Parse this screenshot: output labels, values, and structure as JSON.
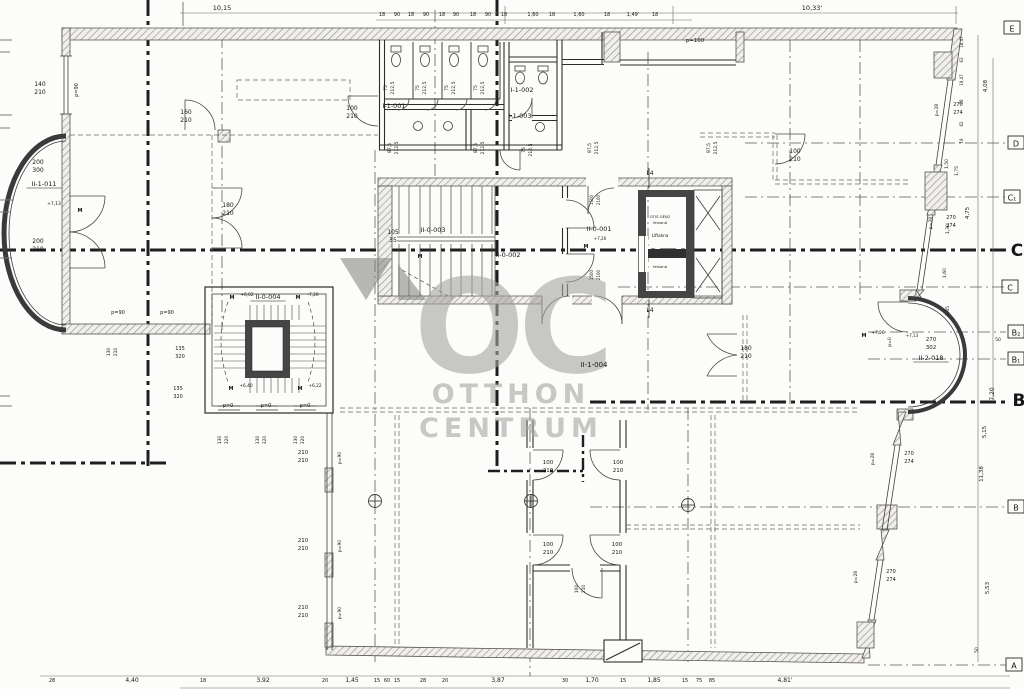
{
  "watermark": {
    "logo": "OC",
    "line1": "OTTHON",
    "line2": "CENTRUM",
    "color": "#a5a4a2"
  },
  "colors": {
    "ink": "#161616",
    "wall_dark": "#454545",
    "hatch_line": "#8f8d89",
    "axis": "#1f1f1f",
    "background": "#fcfcfa"
  },
  "grid_letters": [
    {
      "t": "E",
      "x": 1012,
      "y": 28
    },
    {
      "t": "D",
      "x": 1016,
      "y": 143
    },
    {
      "t": "C₁",
      "x": 1012,
      "y": 197
    },
    {
      "t": "C",
      "x": 1017,
      "y": 250,
      "big": 1
    },
    {
      "t": "C",
      "x": 1010,
      "y": 287
    },
    {
      "t": "B₂",
      "x": 1016,
      "y": 332
    },
    {
      "t": "B₁",
      "x": 1016,
      "y": 359
    },
    {
      "t": "B",
      "x": 1019,
      "y": 400,
      "big": 1
    },
    {
      "t": "B",
      "x": 1016,
      "y": 507
    },
    {
      "t": "A",
      "x": 1014,
      "y": 665
    }
  ],
  "annotations": [
    {
      "k": "room",
      "t": "II-1-011",
      "x": 44,
      "y": 186,
      "s": 6.5,
      "u": 1
    },
    {
      "k": "room",
      "t": "I-1-001",
      "x": 394,
      "y": 108,
      "s": 6.5
    },
    {
      "k": "room",
      "t": "I-1-002",
      "x": 522,
      "y": 92,
      "s": 6.5
    },
    {
      "k": "room",
      "t": "I-1-003",
      "x": 520,
      "y": 118,
      "s": 6.5
    },
    {
      "k": "room",
      "t": "II-0-003",
      "x": 433,
      "y": 232,
      "s": 6.5
    },
    {
      "k": "room",
      "t": "II-0-001",
      "x": 599,
      "y": 231,
      "s": 6.5
    },
    {
      "k": "room",
      "t": "II-0-002",
      "x": 508,
      "y": 257,
      "s": 6.5
    },
    {
      "k": "room",
      "t": "II-0-004",
      "x": 268,
      "y": 299,
      "s": 6.5,
      "u": 1
    },
    {
      "k": "room",
      "t": "II-1-004",
      "x": 594,
      "y": 367,
      "s": 7
    },
    {
      "k": "room",
      "t": "II-2-018",
      "x": 931,
      "y": 360,
      "s": 6.5,
      "u": 1
    },
    {
      "k": "dim",
      "t": "10,15",
      "x": 222,
      "y": 10,
      "s": 6.5
    },
    {
      "k": "dim",
      "t": "10,33'",
      "x": 812,
      "y": 10,
      "s": 6.5
    },
    {
      "k": "dim",
      "t": "18",
      "x": 382,
      "y": 16,
      "s": 5
    },
    {
      "k": "dim",
      "t": "90",
      "x": 397,
      "y": 16,
      "s": 5
    },
    {
      "k": "dim",
      "t": "18",
      "x": 411,
      "y": 16,
      "s": 5
    },
    {
      "k": "dim",
      "t": "90",
      "x": 426,
      "y": 16,
      "s": 5
    },
    {
      "k": "dim",
      "t": "18",
      "x": 442,
      "y": 16,
      "s": 5
    },
    {
      "k": "dim",
      "t": "90",
      "x": 456,
      "y": 16,
      "s": 5
    },
    {
      "k": "dim",
      "t": "18",
      "x": 473,
      "y": 16,
      "s": 5
    },
    {
      "k": "dim",
      "t": "90",
      "x": 488,
      "y": 16,
      "s": 5
    },
    {
      "k": "dim",
      "t": "18",
      "x": 504,
      "y": 16,
      "s": 5
    },
    {
      "k": "dim",
      "t": "1,60",
      "x": 533,
      "y": 16,
      "s": 5
    },
    {
      "k": "dim",
      "t": "18",
      "x": 552,
      "y": 16,
      "s": 5
    },
    {
      "k": "dim",
      "t": "1,60",
      "x": 579,
      "y": 16,
      "s": 5
    },
    {
      "k": "dim",
      "t": "18",
      "x": 607,
      "y": 16,
      "s": 5
    },
    {
      "k": "dim",
      "t": "1,49'",
      "x": 633,
      "y": 16,
      "s": 5
    },
    {
      "k": "dim",
      "t": "18",
      "x": 655,
      "y": 16,
      "s": 5
    },
    {
      "k": "dim",
      "t": "p=100",
      "x": 695,
      "y": 42,
      "s": 5.5
    },
    {
      "k": "dim",
      "t": "75",
      "x": 387,
      "y": 88,
      "r": 1,
      "s": 4.5
    },
    {
      "k": "dim",
      "t": "212,5",
      "x": 394,
      "y": 88,
      "r": 1,
      "s": 4.5
    },
    {
      "k": "dim",
      "t": "75",
      "x": 419,
      "y": 88,
      "r": 1,
      "s": 4.5
    },
    {
      "k": "dim",
      "t": "212,5",
      "x": 426,
      "y": 88,
      "r": 1,
      "s": 4.5
    },
    {
      "k": "dim",
      "t": "75",
      "x": 448,
      "y": 88,
      "r": 1,
      "s": 4.5
    },
    {
      "k": "dim",
      "t": "212,5",
      "x": 455,
      "y": 88,
      "r": 1,
      "s": 4.5
    },
    {
      "k": "dim",
      "t": "75",
      "x": 477,
      "y": 88,
      "r": 1,
      "s": 4.5
    },
    {
      "k": "dim",
      "t": "212,5",
      "x": 484,
      "y": 88,
      "r": 1,
      "s": 4.5
    },
    {
      "k": "dim",
      "t": "87,5",
      "x": 391,
      "y": 148,
      "r": 1,
      "s": 4.5
    },
    {
      "k": "dim",
      "t": "212,5",
      "x": 398,
      "y": 148,
      "r": 1,
      "s": 4.5
    },
    {
      "k": "dim",
      "t": "87,5",
      "x": 477,
      "y": 148,
      "r": 1,
      "s": 4.5
    },
    {
      "k": "dim",
      "t": "212,5",
      "x": 484,
      "y": 148,
      "r": 1,
      "s": 4.5
    },
    {
      "k": "dim",
      "t": "75",
      "x": 525,
      "y": 150,
      "r": 1,
      "s": 4.5
    },
    {
      "k": "dim",
      "t": "212,5",
      "x": 532,
      "y": 150,
      "r": 1,
      "s": 4.5
    },
    {
      "k": "dim",
      "t": "87,5",
      "x": 591,
      "y": 148,
      "r": 1,
      "s": 4.5
    },
    {
      "k": "dim",
      "t": "212,5",
      "x": 598,
      "y": 148,
      "r": 1,
      "s": 4.5
    },
    {
      "k": "dim",
      "t": "87,5",
      "x": 710,
      "y": 148,
      "r": 1,
      "s": 4.5
    },
    {
      "k": "dim",
      "t": "212,5",
      "x": 717,
      "y": 148,
      "r": 1,
      "s": 4.5
    },
    {
      "k": "dim",
      "t": "140",
      "x": 40,
      "y": 86,
      "s": 6
    },
    {
      "k": "dim",
      "t": "210",
      "x": 40,
      "y": 94,
      "s": 6
    },
    {
      "k": "dim",
      "t": "p=90",
      "x": 78,
      "y": 90,
      "r": 1,
      "s": 5
    },
    {
      "k": "dim",
      "t": "160",
      "x": 186,
      "y": 114,
      "s": 6
    },
    {
      "k": "dim",
      "t": "210",
      "x": 186,
      "y": 122,
      "s": 6
    },
    {
      "k": "dim",
      "t": "100",
      "x": 352,
      "y": 110,
      "s": 6
    },
    {
      "k": "dim",
      "t": "210",
      "x": 352,
      "y": 118,
      "s": 6
    },
    {
      "k": "dim",
      "t": "180",
      "x": 228,
      "y": 207,
      "s": 6
    },
    {
      "k": "dim",
      "t": "210",
      "x": 228,
      "y": 215,
      "s": 6
    },
    {
      "k": "dim",
      "t": "200",
      "x": 38,
      "y": 164,
      "s": 6
    },
    {
      "k": "dim",
      "t": "300",
      "x": 38,
      "y": 172,
      "s": 6
    },
    {
      "k": "level",
      "t": "+7,13",
      "x": 54,
      "y": 205,
      "s": 4.5
    },
    {
      "k": "mark",
      "t": "M",
      "x": 80,
      "y": 212,
      "s": 5,
      "b": 1
    },
    {
      "k": "dim",
      "t": "200",
      "x": 38,
      "y": 243,
      "s": 6
    },
    {
      "k": "dim",
      "t": "210",
      "x": 38,
      "y": 251,
      "s": 6
    },
    {
      "k": "dim",
      "t": "p=90",
      "x": 118,
      "y": 314,
      "s": 5
    },
    {
      "k": "dim",
      "t": "p=90",
      "x": 167,
      "y": 314,
      "s": 5
    },
    {
      "k": "dim",
      "t": "130",
      "x": 110,
      "y": 352,
      "r": 1,
      "s": 4.5
    },
    {
      "k": "dim",
      "t": "210",
      "x": 117,
      "y": 352,
      "r": 1,
      "s": 4.5
    },
    {
      "k": "dim",
      "t": "135",
      "x": 180,
      "y": 350,
      "s": 5
    },
    {
      "k": "dim",
      "t": "320",
      "x": 180,
      "y": 358,
      "s": 5
    },
    {
      "k": "dim",
      "t": "135",
      "x": 178,
      "y": 390,
      "s": 5
    },
    {
      "k": "dim",
      "t": "320",
      "x": 178,
      "y": 398,
      "s": 5
    },
    {
      "k": "dim",
      "t": "105",
      "x": 393,
      "y": 234,
      "s": 6
    },
    {
      "k": "dim",
      "t": "35",
      "x": 393,
      "y": 242,
      "s": 6
    },
    {
      "k": "mark",
      "t": "L4",
      "x": 650,
      "y": 175,
      "s": 6
    },
    {
      "k": "mark",
      "t": "L4",
      "x": 650,
      "y": 312,
      "s": 6
    },
    {
      "k": "dim",
      "t": "1500",
      "x": 593,
      "y": 200,
      "r": 1,
      "s": 4
    },
    {
      "k": "dim",
      "t": "2100",
      "x": 600,
      "y": 200,
      "r": 1,
      "s": 4
    },
    {
      "k": "dim",
      "t": "1500",
      "x": 593,
      "y": 275,
      "r": 1,
      "s": 4
    },
    {
      "k": "dim",
      "t": "2100",
      "x": 600,
      "y": 275,
      "r": 1,
      "s": 4
    },
    {
      "k": "mark",
      "t": "M",
      "x": 586,
      "y": 248,
      "s": 5,
      "b": 1
    },
    {
      "k": "level",
      "t": "+7,26",
      "x": 600,
      "y": 240,
      "s": 4
    },
    {
      "k": "mark",
      "t": "M",
      "x": 420,
      "y": 258,
      "s": 5,
      "b": 1
    },
    {
      "k": "label",
      "t": "OTIS GEN2",
      "x": 660,
      "y": 218,
      "s": 3.8
    },
    {
      "k": "label",
      "t": "felvonó",
      "x": 660,
      "y": 224,
      "s": 3.8
    },
    {
      "k": "label",
      "t": "Liftakna",
      "x": 660,
      "y": 237,
      "s": 4.2
    },
    {
      "k": "label",
      "t": "felvonó",
      "x": 660,
      "y": 268,
      "s": 3.8
    },
    {
      "k": "mark",
      "t": "M",
      "x": 232,
      "y": 299,
      "s": 5,
      "b": 1
    },
    {
      "k": "level",
      "t": "+6,02",
      "x": 247,
      "y": 296,
      "s": 4.3
    },
    {
      "k": "mark",
      "t": "M",
      "x": 298,
      "y": 299,
      "s": 5,
      "b": 1
    },
    {
      "k": "level",
      "t": "-7,20",
      "x": 313,
      "y": 296,
      "s": 4.3
    },
    {
      "k": "mark",
      "t": "M",
      "x": 231,
      "y": 390,
      "s": 5,
      "b": 1
    },
    {
      "k": "level",
      "t": "+6,40",
      "x": 246,
      "y": 387,
      "s": 4.3
    },
    {
      "k": "mark",
      "t": "M",
      "x": 300,
      "y": 390,
      "s": 5,
      "b": 1
    },
    {
      "k": "level",
      "t": "+6,22",
      "x": 315,
      "y": 387,
      "s": 4.3
    },
    {
      "k": "dim",
      "t": "p=0",
      "x": 228,
      "y": 407,
      "s": 5
    },
    {
      "k": "dim",
      "t": "p=0",
      "x": 266,
      "y": 407,
      "s": 5
    },
    {
      "k": "dim",
      "t": "p=0",
      "x": 305,
      "y": 407,
      "s": 5
    },
    {
      "k": "dim",
      "t": "130",
      "x": 221,
      "y": 440,
      "r": 1,
      "s": 4.5
    },
    {
      "k": "dim",
      "t": "320",
      "x": 228,
      "y": 440,
      "r": 1,
      "s": 4.5
    },
    {
      "k": "dim",
      "t": "130",
      "x": 259,
      "y": 440,
      "r": 1,
      "s": 4.5
    },
    {
      "k": "dim",
      "t": "320",
      "x": 266,
      "y": 440,
      "r": 1,
      "s": 4.5
    },
    {
      "k": "dim",
      "t": "130",
      "x": 297,
      "y": 440,
      "r": 1,
      "s": 4.5
    },
    {
      "k": "dim",
      "t": "320",
      "x": 304,
      "y": 440,
      "r": 1,
      "s": 4.5
    },
    {
      "k": "dim",
      "t": "210",
      "x": 303,
      "y": 454,
      "s": 5.5
    },
    {
      "k": "dim",
      "t": "210",
      "x": 303,
      "y": 462,
      "s": 5.5
    },
    {
      "k": "dim",
      "t": "p=90",
      "x": 341,
      "y": 458,
      "r": 1,
      "s": 4.5
    },
    {
      "k": "dim",
      "t": "210",
      "x": 303,
      "y": 542,
      "s": 5.5
    },
    {
      "k": "dim",
      "t": "210",
      "x": 303,
      "y": 550,
      "s": 5.5
    },
    {
      "k": "dim",
      "t": "p=90",
      "x": 341,
      "y": 546,
      "r": 1,
      "s": 4.5
    },
    {
      "k": "dim",
      "t": "210",
      "x": 303,
      "y": 609,
      "s": 5.5
    },
    {
      "k": "dim",
      "t": "210",
      "x": 303,
      "y": 617,
      "s": 5.5
    },
    {
      "k": "dim",
      "t": "p=90",
      "x": 341,
      "y": 613,
      "r": 1,
      "s": 4.5
    },
    {
      "k": "dim",
      "t": "100",
      "x": 795,
      "y": 153,
      "s": 6
    },
    {
      "k": "dim",
      "t": "210",
      "x": 795,
      "y": 161,
      "s": 6
    },
    {
      "k": "dim",
      "t": "180",
      "x": 746,
      "y": 350,
      "s": 6
    },
    {
      "k": "dim",
      "t": "210",
      "x": 746,
      "y": 358,
      "s": 6
    },
    {
      "k": "dim",
      "t": "270",
      "x": 931,
      "y": 341,
      "s": 5.5
    },
    {
      "k": "dim",
      "t": "302",
      "x": 931,
      "y": 349,
      "s": 5.5
    },
    {
      "k": "mark",
      "t": "M",
      "x": 864,
      "y": 337,
      "s": 5,
      "b": 1
    },
    {
      "k": "level",
      "t": "+7,26",
      "x": 878,
      "y": 334,
      "s": 4.3
    },
    {
      "k": "level",
      "t": "+7,13",
      "x": 912,
      "y": 337,
      "s": 4
    },
    {
      "k": "dim",
      "t": "p=0",
      "x": 891,
      "y": 342,
      "r": 1,
      "s": 4.5
    },
    {
      "k": "dim",
      "t": "p=28",
      "x": 938,
      "y": 110,
      "r": 1,
      "s": 4.5
    },
    {
      "k": "dim",
      "t": "270",
      "x": 958,
      "y": 106,
      "s": 5
    },
    {
      "k": "dim",
      "t": "274",
      "x": 958,
      "y": 114,
      "s": 5
    },
    {
      "k": "dim",
      "t": "p=28",
      "x": 932,
      "y": 223,
      "r": 1,
      "s": 4.5
    },
    {
      "k": "dim",
      "t": "270",
      "x": 951,
      "y": 219,
      "s": 5
    },
    {
      "k": "dim",
      "t": "274",
      "x": 951,
      "y": 227,
      "s": 5
    },
    {
      "k": "dim",
      "t": "p=28",
      "x": 874,
      "y": 459,
      "r": 1,
      "s": 4.5
    },
    {
      "k": "dim",
      "t": "270",
      "x": 909,
      "y": 455,
      "s": 5
    },
    {
      "k": "dim",
      "t": "274",
      "x": 909,
      "y": 463,
      "s": 5
    },
    {
      "k": "dim",
      "t": "p=28",
      "x": 857,
      "y": 577,
      "r": 1,
      "s": 4.5
    },
    {
      "k": "dim",
      "t": "270",
      "x": 891,
      "y": 573,
      "s": 5
    },
    {
      "k": "dim",
      "t": "274",
      "x": 891,
      "y": 581,
      "s": 5
    },
    {
      "k": "dim",
      "t": "18,47",
      "x": 963,
      "y": 42,
      "r": 1,
      "s": 4
    },
    {
      "k": "dim",
      "t": "63",
      "x": 963,
      "y": 60,
      "r": 1,
      "s": 4
    },
    {
      "k": "dim",
      "t": "19,47",
      "x": 963,
      "y": 80,
      "r": 1,
      "s": 4
    },
    {
      "k": "dim",
      "t": "78",
      "x": 963,
      "y": 102,
      "r": 1,
      "s": 4
    },
    {
      "k": "dim",
      "t": "62",
      "x": 963,
      "y": 124,
      "r": 1,
      "s": 4
    },
    {
      "k": "dim",
      "t": "19",
      "x": 963,
      "y": 141,
      "r": 1,
      "s": 4
    },
    {
      "k": "dim",
      "t": "4,08",
      "x": 987,
      "y": 86,
      "r": 1,
      "s": 5.5
    },
    {
      "k": "dim",
      "t": "1,50",
      "x": 948,
      "y": 164,
      "r": 1,
      "s": 4.5
    },
    {
      "k": "dim",
      "t": "1,75",
      "x": 958,
      "y": 171,
      "r": 1,
      "s": 4.5
    },
    {
      "k": "dim",
      "t": "4,75",
      "x": 969,
      "y": 213,
      "r": 1,
      "s": 5.5
    },
    {
      "k": "dim",
      "t": "1,30",
      "x": 949,
      "y": 229,
      "r": 1,
      "s": 4.5
    },
    {
      "k": "dim",
      "t": "1,60",
      "x": 946,
      "y": 273,
      "r": 1,
      "s": 4.5
    },
    {
      "k": "dim",
      "t": "1,85",
      "x": 949,
      "y": 311,
      "r": 1,
      "s": 4.5
    },
    {
      "k": "dim",
      "t": "50",
      "x": 998,
      "y": 341,
      "s": 4.5
    },
    {
      "k": "dim",
      "t": "7,20",
      "x": 994,
      "y": 394,
      "r": 1,
      "s": 6
    },
    {
      "k": "dim",
      "t": "5,15",
      "x": 986,
      "y": 432,
      "r": 1,
      "s": 5.5
    },
    {
      "k": "dim",
      "t": "11,38",
      "x": 983,
      "y": 474,
      "r": 1,
      "s": 5.5
    },
    {
      "k": "dim",
      "t": "5,53",
      "x": 989,
      "y": 588,
      "r": 1,
      "s": 5.5
    },
    {
      "k": "dim",
      "t": "50",
      "x": 978,
      "y": 650,
      "r": 1,
      "s": 4.5
    },
    {
      "k": "dim",
      "t": "100",
      "x": 548,
      "y": 464,
      "s": 5.5
    },
    {
      "k": "dim",
      "t": "210",
      "x": 548,
      "y": 472,
      "s": 5.5
    },
    {
      "k": "dim",
      "t": "100",
      "x": 618,
      "y": 464,
      "s": 5.5
    },
    {
      "k": "dim",
      "t": "210",
      "x": 618,
      "y": 472,
      "s": 5.5
    },
    {
      "k": "dim",
      "t": "100",
      "x": 548,
      "y": 546,
      "s": 5.5
    },
    {
      "k": "dim",
      "t": "210",
      "x": 548,
      "y": 554,
      "s": 5.5
    },
    {
      "k": "dim",
      "t": "100",
      "x": 617,
      "y": 546,
      "s": 5.5
    },
    {
      "k": "dim",
      "t": "210",
      "x": 617,
      "y": 554,
      "s": 5.5
    },
    {
      "k": "dim",
      "t": "100",
      "x": 578,
      "y": 589,
      "r": 1,
      "s": 4.5
    },
    {
      "k": "dim",
      "t": "210",
      "x": 585,
      "y": 589,
      "r": 1,
      "s": 4.5
    },
    {
      "k": "dim",
      "t": "28",
      "x": 52,
      "y": 682,
      "s": 5
    },
    {
      "k": "dim",
      "t": "4,40",
      "x": 132,
      "y": 682,
      "s": 6
    },
    {
      "k": "dim",
      "t": "18",
      "x": 203,
      "y": 682,
      "s": 5
    },
    {
      "k": "dim",
      "t": "3,92",
      "x": 263,
      "y": 682,
      "s": 6
    },
    {
      "k": "dim",
      "t": "20",
      "x": 325,
      "y": 682,
      "s": 5
    },
    {
      "k": "dim",
      "t": "1,45",
      "x": 352,
      "y": 682,
      "s": 6
    },
    {
      "k": "dim",
      "t": "15",
      "x": 377,
      "y": 682,
      "s": 5
    },
    {
      "k": "dim",
      "t": "60",
      "x": 387,
      "y": 682,
      "s": 5
    },
    {
      "k": "dim",
      "t": "15",
      "x": 397,
      "y": 682,
      "s": 5
    },
    {
      "k": "dim",
      "t": "28",
      "x": 423,
      "y": 682,
      "s": 5
    },
    {
      "k": "dim",
      "t": "20",
      "x": 445,
      "y": 682,
      "s": 5
    },
    {
      "k": "dim",
      "t": "3,87",
      "x": 498,
      "y": 682,
      "s": 6
    },
    {
      "k": "dim",
      "t": "30",
      "x": 565,
      "y": 682,
      "s": 5
    },
    {
      "k": "dim",
      "t": "1,70",
      "x": 592,
      "y": 682,
      "s": 6
    },
    {
      "k": "dim",
      "t": "15",
      "x": 623,
      "y": 682,
      "s": 5
    },
    {
      "k": "dim",
      "t": "1,85",
      "x": 654,
      "y": 682,
      "s": 6
    },
    {
      "k": "dim",
      "t": "15",
      "x": 685,
      "y": 682,
      "s": 5
    },
    {
      "k": "dim",
      "t": "75",
      "x": 699,
      "y": 682,
      "s": 5
    },
    {
      "k": "dim",
      "t": "85",
      "x": 712,
      "y": 682,
      "s": 5
    },
    {
      "k": "dim",
      "t": "4,81'",
      "x": 785,
      "y": 682,
      "s": 6
    }
  ]
}
